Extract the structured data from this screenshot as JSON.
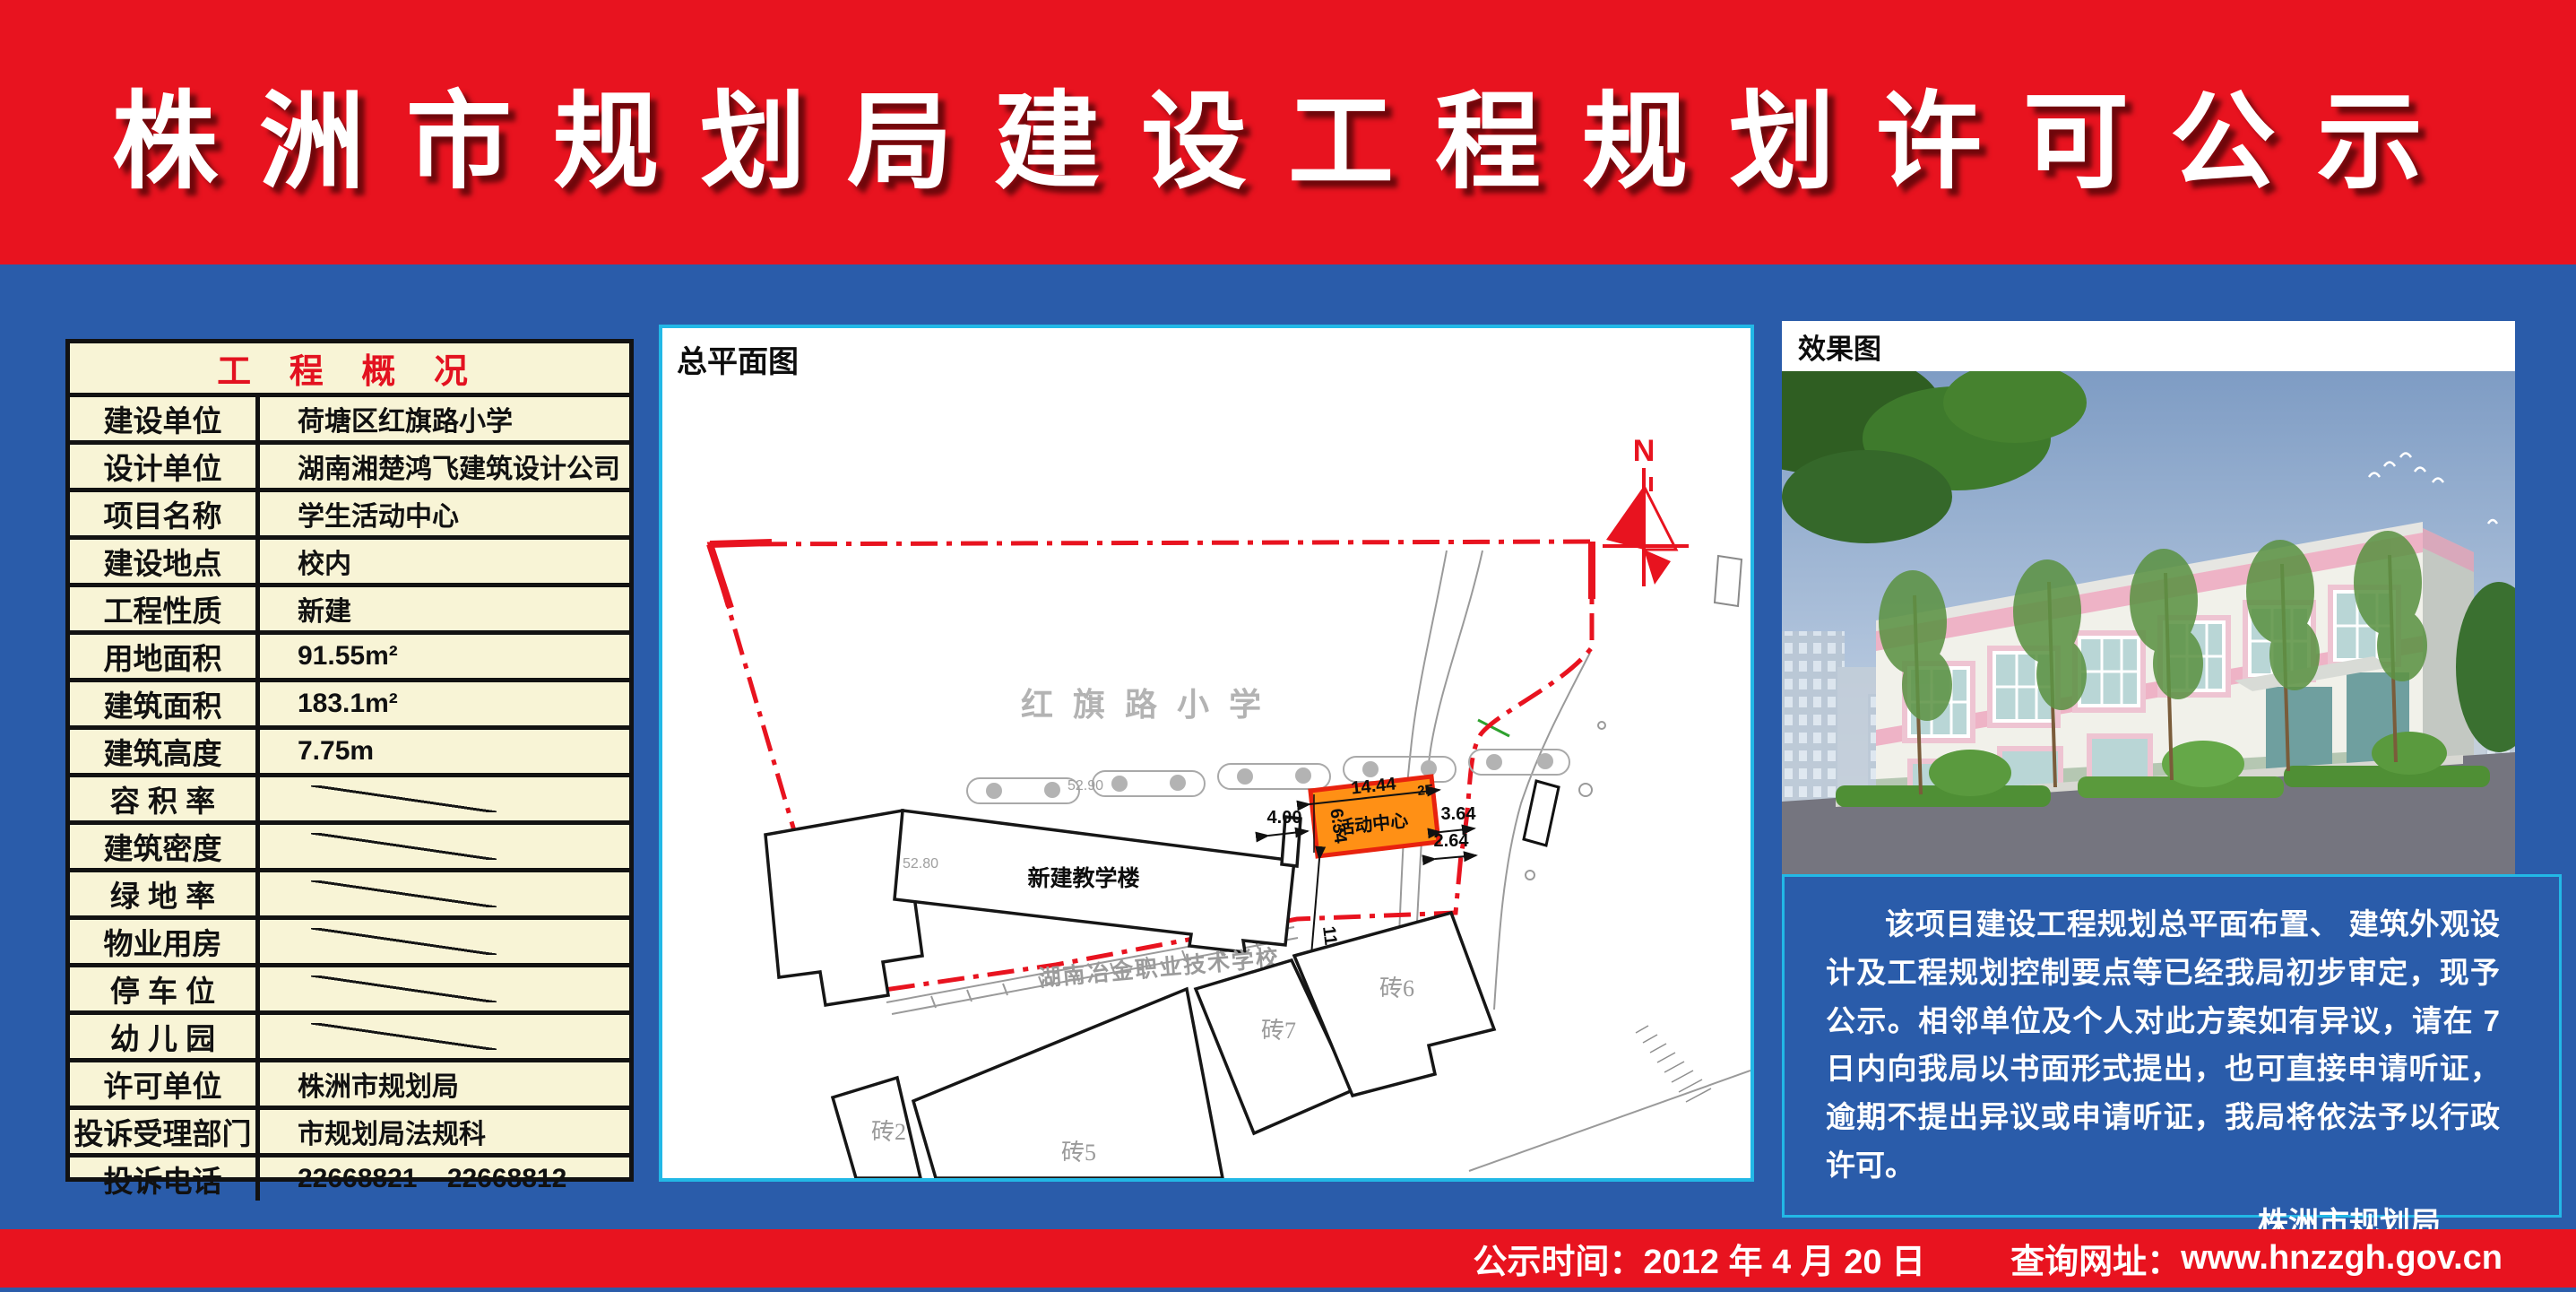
{
  "header": {
    "title": "株洲市规划局建设工程规划许可公示"
  },
  "table": {
    "title": "工 程 概 况",
    "rows": [
      {
        "label": "建设单位",
        "value": "荷塘区红旗路小学",
        "type": "text"
      },
      {
        "label": "设计单位",
        "value": "湖南湘楚鸿飞建筑设计公司",
        "type": "text"
      },
      {
        "label": "项目名称",
        "value": "学生活动中心",
        "type": "text"
      },
      {
        "label": "建设地点",
        "value": "校内",
        "type": "text"
      },
      {
        "label": "工程性质",
        "value": "新建",
        "type": "text"
      },
      {
        "label": "用地面积",
        "value": "91.55m²",
        "type": "text"
      },
      {
        "label": "建筑面积",
        "value": "183.1m²",
        "type": "text"
      },
      {
        "label": "建筑高度",
        "value": "7.75m",
        "type": "text"
      },
      {
        "label": "容 积 率",
        "value": "",
        "type": "slash"
      },
      {
        "label": "建筑密度",
        "value": "",
        "type": "slash"
      },
      {
        "label": "绿 地 率",
        "value": "",
        "type": "slash"
      },
      {
        "label": "物业用房",
        "value": "",
        "type": "slash"
      },
      {
        "label": "停 车 位",
        "value": "",
        "type": "slash"
      },
      {
        "label": "幼 儿 园",
        "value": "",
        "type": "slash"
      },
      {
        "label": "许可单位",
        "value": "株洲市规划局",
        "type": "text"
      },
      {
        "label": "投诉受理部门",
        "value": "市规划局法规科",
        "type": "text"
      },
      {
        "label": "投诉电话",
        "value": "22668821    22668812",
        "type": "text"
      }
    ]
  },
  "siteplan": {
    "title": "总平面图",
    "school_name": "红旗路小学",
    "teaching_building": "新建教学楼",
    "activity_center": "活动中心",
    "floors": "2F",
    "south_school": "湖南冶金职业技术学校",
    "north_label": "N",
    "dims": {
      "width": "14.44",
      "depth": "6.34",
      "left": "4.00",
      "right": "3.64",
      "offset": "2.64",
      "south": "11.89"
    },
    "elevations": [
      "52.90",
      "52.80"
    ],
    "bricks": [
      "砖2",
      "砖5",
      "砖7",
      "砖6"
    ]
  },
  "rendering": {
    "title": "效果图"
  },
  "notice": {
    "body": "该项目建设工程规划总平面布置、 建筑外观设计及工程规划控制要点等已经我局初步审定，现予公示。相邻单位及个人对此方案如有异议，请在 7 日内向我局以书面形式提出，也可直接申请听证，逾期不提出异议或申请听证，我局将依法予以行政许可。",
    "signature": "株洲市规划局",
    "date": "2012 年 4 月 20 日"
  },
  "footer": {
    "time_label": "公示时间：",
    "time_value": "2012 年 4 月 20 日",
    "url_label": "查询网址：",
    "url_value": "www.hnzzgh.gov.cn"
  },
  "colors": {
    "banner_red": "#e8131f",
    "body_blue": "#2a5caa",
    "panel_cyan": "#22b8e6",
    "table_cream": "#f8f4d6",
    "building_orange": "#ff9015",
    "boundary_red": "#e8131f"
  }
}
